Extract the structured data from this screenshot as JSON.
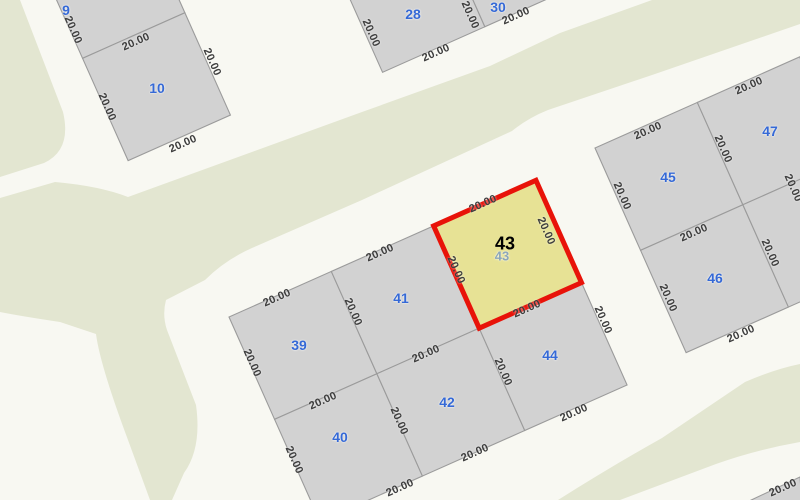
{
  "map": {
    "dimension_label": "20.00",
    "selected_parcel": "43",
    "colors": {
      "road_bg": "#f8f8f2",
      "block_green": "#e3e6d1",
      "parcel_fill": "#d2d2d2",
      "parcel_stroke": "#9b9b9b",
      "selected_fill": "#e7e295",
      "selected_stroke": "#e81309",
      "number_color": "#3569d6",
      "dim_color": "#3d3d3d"
    },
    "geometry": {
      "angle_deg": -24,
      "cell_px": 112
    },
    "blocks": [
      {
        "id": "northwest",
        "origin": [
          37,
          -44
        ],
        "cells": [
          {
            "num": "9",
            "col": 0,
            "row": 0
          },
          {
            "num": "10",
            "col": 0,
            "row": 1
          }
        ]
      },
      {
        "id": "north",
        "origin": [
          337,
          -30
        ],
        "cells": [
          {
            "num": "28",
            "col": 0,
            "row": 0
          },
          {
            "num": "30",
            "col": 1,
            "row": 0
          }
        ]
      },
      {
        "id": "center",
        "origin": [
          229,
          317
        ],
        "cells": [
          {
            "num": "39",
            "col": 0,
            "row": 0
          },
          {
            "num": "41",
            "col": 1,
            "row": 0
          },
          {
            "num": "43",
            "col": 2,
            "row": 0,
            "selected": true
          },
          {
            "num": "40",
            "col": 0,
            "row": 1
          },
          {
            "num": "42",
            "col": 1,
            "row": 1
          },
          {
            "num": "44",
            "col": 2,
            "row": 1
          }
        ]
      },
      {
        "id": "east",
        "origin": [
          595,
          148
        ],
        "cells": [
          {
            "num": "45",
            "col": 0,
            "row": 0
          },
          {
            "num": "47",
            "col": 1,
            "row": 0
          },
          {
            "num": "46",
            "col": 0,
            "row": 1
          },
          {
            "num": "",
            "col": 1,
            "row": 1
          }
        ]
      }
    ],
    "number_labels": [
      {
        "text": "9",
        "x": 66,
        "y": 10
      },
      {
        "text": "10",
        "x": 157,
        "y": 88
      },
      {
        "text": "28",
        "x": 413,
        "y": 14
      },
      {
        "text": "30",
        "x": 498,
        "y": 7
      },
      {
        "text": "39",
        "x": 299,
        "y": 345
      },
      {
        "text": "40",
        "x": 340,
        "y": 437
      },
      {
        "text": "41",
        "x": 401,
        "y": 298
      },
      {
        "text": "42",
        "x": 447,
        "y": 402
      },
      {
        "text": "44",
        "x": 550,
        "y": 355
      },
      {
        "text": "45",
        "x": 668,
        "y": 177
      },
      {
        "text": "46",
        "x": 715,
        "y": 278
      },
      {
        "text": "47",
        "x": 770,
        "y": 131
      },
      {
        "text": "43",
        "x": 502,
        "y": 256,
        "variant": "ghost"
      },
      {
        "text": "43",
        "x": 505,
        "y": 244,
        "variant": "selected"
      }
    ],
    "dim_labels": [
      {
        "x": 73,
        "y": 30,
        "rot": 66
      },
      {
        "x": 136,
        "y": 42,
        "rot": -24
      },
      {
        "x": 107,
        "y": 107,
        "rot": 66
      },
      {
        "x": 212,
        "y": 62,
        "rot": 66
      },
      {
        "x": 183,
        "y": 144,
        "rot": -24
      },
      {
        "x": 371,
        "y": 33,
        "rot": 66
      },
      {
        "x": 436,
        "y": 53,
        "rot": -24
      },
      {
        "x": 470,
        "y": 15,
        "rot": 66
      },
      {
        "x": 516,
        "y": 16,
        "rot": -24
      },
      {
        "x": 277,
        "y": 298,
        "rot": -24
      },
      {
        "x": 252,
        "y": 363,
        "rot": 66
      },
      {
        "x": 353,
        "y": 312,
        "rot": 66
      },
      {
        "x": 380,
        "y": 253,
        "rot": -24
      },
      {
        "x": 323,
        "y": 401,
        "rot": -24
      },
      {
        "x": 294,
        "y": 460,
        "rot": 66
      },
      {
        "x": 400,
        "y": 488,
        "rot": -24
      },
      {
        "x": 426,
        "y": 354,
        "rot": -24
      },
      {
        "x": 399,
        "y": 421,
        "rot": 66
      },
      {
        "x": 475,
        "y": 453,
        "rot": -24
      },
      {
        "x": 503,
        "y": 372,
        "rot": 66
      },
      {
        "x": 527,
        "y": 309,
        "rot": -24
      },
      {
        "x": 603,
        "y": 320,
        "rot": 66
      },
      {
        "x": 574,
        "y": 413,
        "rot": -24
      },
      {
        "x": 483,
        "y": 204,
        "rot": -24
      },
      {
        "x": 546,
        "y": 231,
        "rot": 66
      },
      {
        "x": 456,
        "y": 270,
        "rot": 66
      },
      {
        "x": 648,
        "y": 131,
        "rot": -24
      },
      {
        "x": 622,
        "y": 196,
        "rot": 66
      },
      {
        "x": 723,
        "y": 149,
        "rot": 66
      },
      {
        "x": 749,
        "y": 86,
        "rot": -24
      },
      {
        "x": 694,
        "y": 233,
        "rot": -24
      },
      {
        "x": 668,
        "y": 298,
        "rot": 66
      },
      {
        "x": 741,
        "y": 334,
        "rot": -24
      },
      {
        "x": 770,
        "y": 253,
        "rot": 66
      },
      {
        "x": 793,
        "y": 188,
        "rot": 66
      },
      {
        "x": 783,
        "y": 488,
        "rot": -24
      }
    ]
  }
}
